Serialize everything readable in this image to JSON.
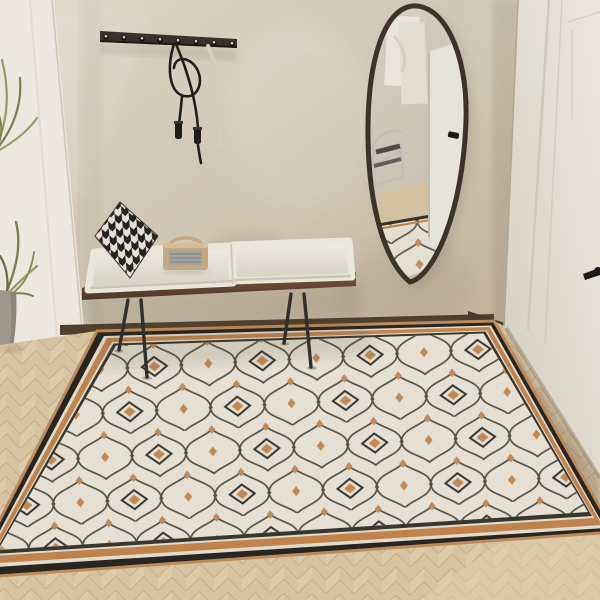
{
  "meta": {
    "title": "Entryway interior product photo",
    "description": "Beige entryway corner with wall coat rack, leather strap, houndstooth pillow, white bench cushions, retro radio, irregular oval wall mirror reflecting a chrome chair and white door, potted plant behind a sheer white curtain, herringbone oak floor, and a large cream ogee-trellis area rug with black and terracotta border."
  },
  "palette": {
    "wall": "#d7ccba",
    "wall_light": "#e7dfd1",
    "wall_shadow": "#bfae95",
    "curtain": "#f3efe6",
    "plant_leaf": "#7c8455",
    "plant_leaf_light": "#9aa06b",
    "pot": "#a39c90",
    "rack_wood": "#3a322b",
    "strap": "#211d1a",
    "strap_light": "#dcd3c1",
    "bench_wood": "#6b4a36",
    "bench_wood_dark": "#4e362a",
    "leg_metal": "#34302c",
    "cushion": "#f1ede2",
    "cushion_shadow": "#d8d2c4",
    "pillow_black": "#272320",
    "pillow_white": "#ece8e0",
    "radio_body": "#c9ad85",
    "radio_grille": "#a7aba4",
    "mirror_frame": "#3f342b",
    "mirror_glass": "#d7cec0",
    "reflect_door": "#edeade",
    "chrome": "#c7c3bb",
    "door": "#f0ebe1",
    "door_groove": "#d5cec0",
    "handle_black": "#1c1a17",
    "floor_wood": "#dcc9a7",
    "floor_warm": "#e8d7b4",
    "floor_seam": "#c9b28b",
    "rug_field": "#ebe6d7",
    "rug_line": "#4b493a",
    "rug_accent": "#c6874f",
    "rug_motif": "#2e2b25",
    "rug_border_black": "#2b2620",
    "rug_border_white": "#e8e2d2",
    "rug_edge_tan": "#bf8e5c",
    "baseboard": "#53402f"
  },
  "scene": {
    "objects": [
      {
        "name": "coat-rack",
        "hooks": 8,
        "note": "dark wood wall bar, metal peg hooks"
      },
      {
        "name": "leather-strap",
        "note": "black looped strap with two tassel ends hanging from a hook"
      },
      {
        "name": "light-strap",
        "note": "pale strap hanging behind the black one"
      },
      {
        "name": "bench",
        "legs": 4,
        "cushions": 2,
        "note": "walnut slab bench with white seat cushions on thin metal legs"
      },
      {
        "name": "houndstooth-pillow",
        "note": "black and white pillow at left end of bench"
      },
      {
        "name": "retro-radio",
        "note": "tan radio with grey grille and carry handle on bench"
      },
      {
        "name": "wall-mirror",
        "note": "irregular oval mirror, thin dark frame; reflects relief art, chrome chair, white door and rug"
      },
      {
        "name": "sheer-curtain",
        "note": "white panel at left edge"
      },
      {
        "name": "potted-plant",
        "note": "green fronds in grey cement pot at far left"
      },
      {
        "name": "area-rug",
        "note": "cream ogee trellis rug, dark olive lattice, terracotta diamond dots and diamond medallions, border: tan edge, black band, white line, terracotta band, white line, black line"
      },
      {
        "name": "white-door",
        "note": "panelled white door at right with black lever handle"
      },
      {
        "name": "wood-floor",
        "note": "light oak herringbone"
      }
    ]
  }
}
